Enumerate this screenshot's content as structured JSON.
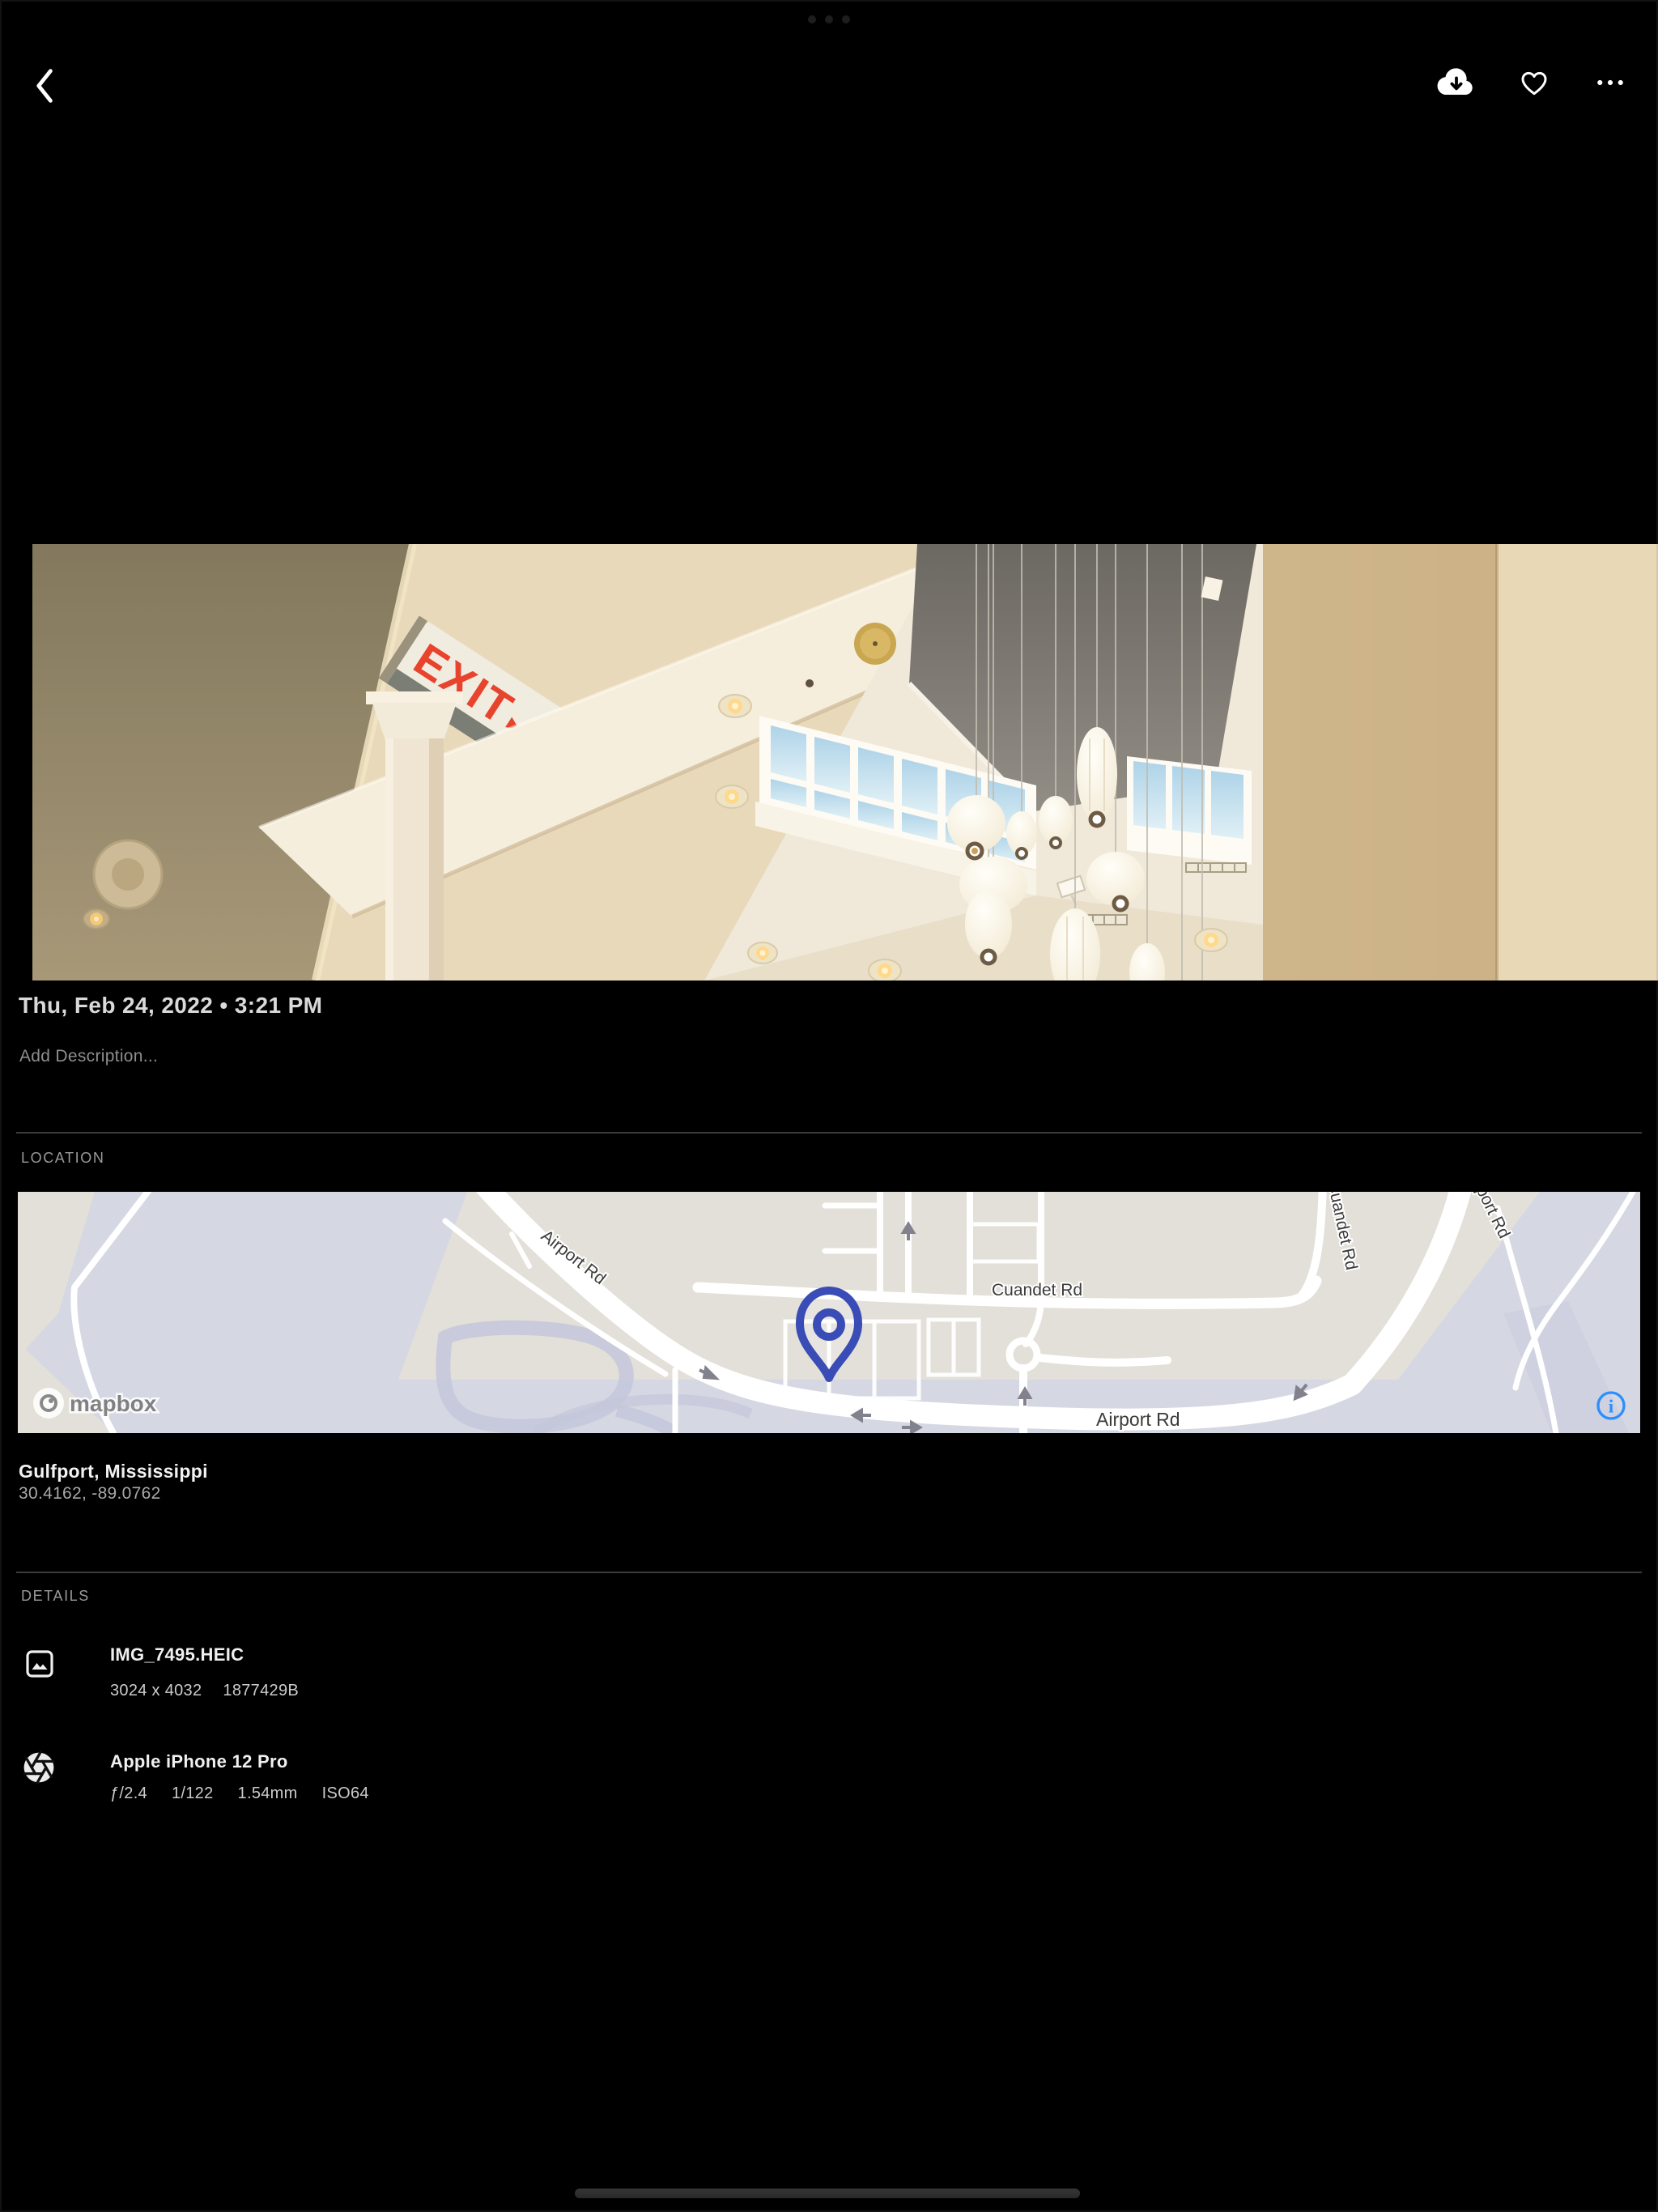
{
  "toolbar": {
    "back": "back",
    "download": "download",
    "favorite": "favorite",
    "more": "more"
  },
  "photo": {
    "exit_sign": "EXIT",
    "exit_arrow": "▸"
  },
  "meta": {
    "date_line": "Thu, Feb 24, 2022 • 3:21 PM",
    "description_placeholder": "Add Description..."
  },
  "location": {
    "label": "LOCATION",
    "place": "Gulfport, Mississippi",
    "coordinates": "30.4162, -89.0762",
    "map": {
      "attribution": "mapbox",
      "road_west": "Airport Rd",
      "road_cuandet": "Cuandet Rd",
      "road_south": "Airport Rd",
      "road_northeast": "Airport Rd",
      "road_north_partial": "Cuandet Rd",
      "pin_color": "#3a4cb5",
      "info_color": "#2b8fff",
      "land_color": "#e3e0d9",
      "water_color": "#d5d7e3",
      "road_color": "#ffffff",
      "label_color": "#3b3b3b"
    }
  },
  "details": {
    "label": "DETAILS",
    "file": {
      "name": "IMG_7495.HEIC",
      "dimensions": "3024 x 4032",
      "size": "1877429B"
    },
    "camera": {
      "name": "Apple iPhone 12 Pro",
      "settings": [
        "ƒ/2.4",
        "1/122",
        "1.54mm",
        "ISO64"
      ]
    }
  }
}
